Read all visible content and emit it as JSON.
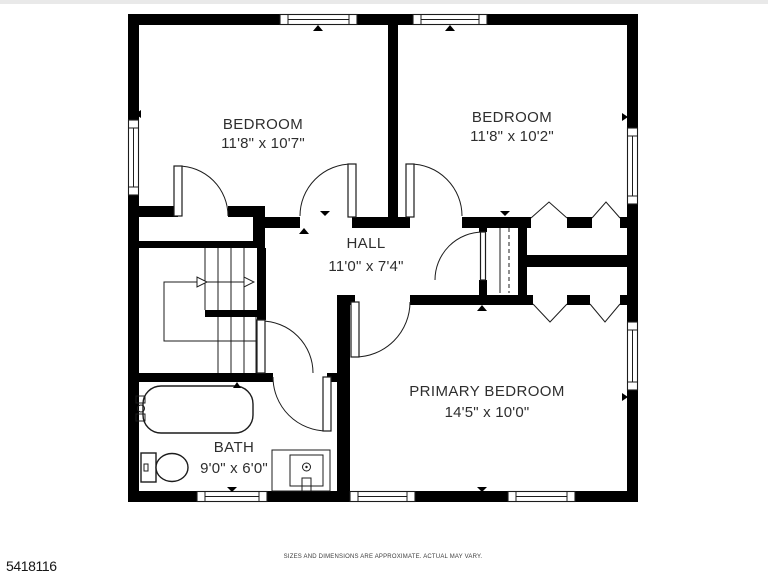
{
  "colors": {
    "background": "#ffffff",
    "wall": "#000000",
    "line": "#1c1c1c",
    "text": "#2e2e2e",
    "top_edge_strip": "#e9e9e9"
  },
  "rooms": {
    "bedroom1": {
      "name": "BEDROOM",
      "dims": "11'8\" x 10'7\""
    },
    "bedroom2": {
      "name": "BEDROOM",
      "dims": "11'8\" x 10'2\""
    },
    "hall": {
      "name": "HALL",
      "dims": "11'0\" x 7'4\""
    },
    "primary": {
      "name": "PRIMARY BEDROOM",
      "dims": "14'5\" x 10'0\""
    },
    "bath": {
      "name": "BATH",
      "dims": "9'0\" x 6'0\""
    }
  },
  "fixtures": [
    "staircase",
    "bathtub",
    "toilet",
    "sink-vanity",
    "hall-closet",
    "bifold-closet-doors",
    "windows",
    "doors"
  ],
  "footer": {
    "listing_id": "5418116",
    "disclaimer": "SIZES AND DIMENSIONS ARE APPROXIMATE. ACTUAL MAY VARY."
  }
}
